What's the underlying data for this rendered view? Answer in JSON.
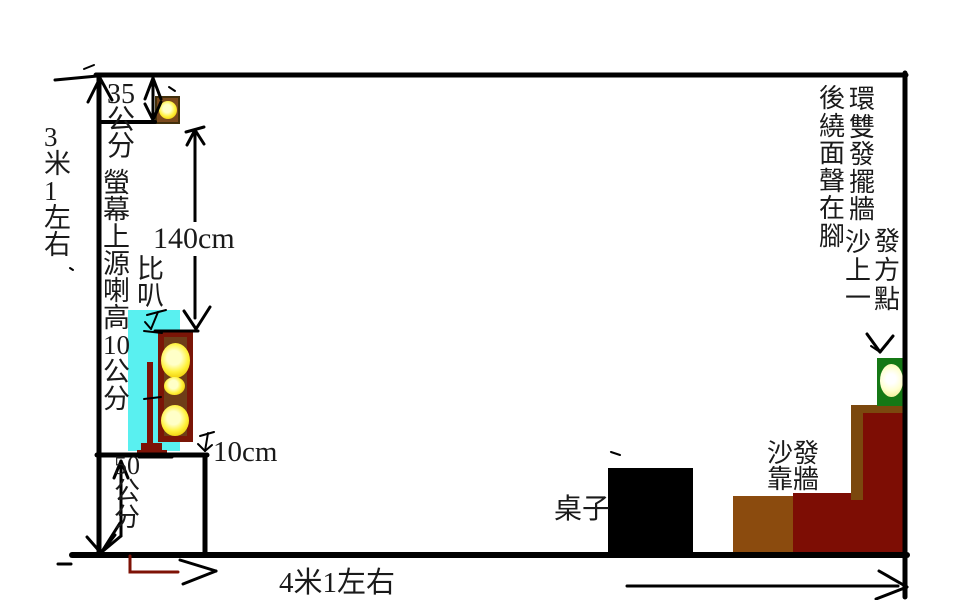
{
  "title": "room-speaker-layout-diagram",
  "dimension_labels": {
    "room_height": "3米1左右",
    "ceiling_to_speaker": "35公分",
    "screen_note_col_main": "螢幕上源喇高10公分",
    "screen_note_col_side": "比叭",
    "speaker_top_height": "140cm",
    "platform_edge_gap": "10cm",
    "platform_height": "50公分",
    "room_width": "4米1左右"
  },
  "object_labels": {
    "table": "桌子",
    "sofa": "沙發\n靠牆"
  },
  "notes": {
    "rear_surround_col_left": "後繞面聲在腳",
    "rear_surround_col_right": "環雙發擺牆",
    "rear_position_col_left": "沙上一",
    "rear_position_col_right": "發方點"
  },
  "objects": {
    "ceiling_speaker": "speaker-icon",
    "screen": "tv-screen",
    "front_tower_speaker": "tower-speaker-icon",
    "screen_stand": "stand",
    "platform": "tv-cabinet",
    "table": "table-block",
    "sofa": "sofa-blocks",
    "rear_speaker": "rear-speaker-icon"
  },
  "colors": {
    "screen_cyan": "#59F0F0",
    "speaker_cabinet_brown": "#6E3D18",
    "speaker_border_maroon": "#7A1507",
    "small_speaker_brown": "#7B4A1D",
    "driver_yellow": "#FFE92C",
    "stand_dark_red": "#7E1206",
    "table_black": "#000000",
    "sofa_maroon": "#7D0D04",
    "sofa_brown": "#8B4B0E",
    "rear_speaker_green": "#157815",
    "corner_arrow_dark_red": "#7E1206",
    "line_black": "#000000"
  }
}
